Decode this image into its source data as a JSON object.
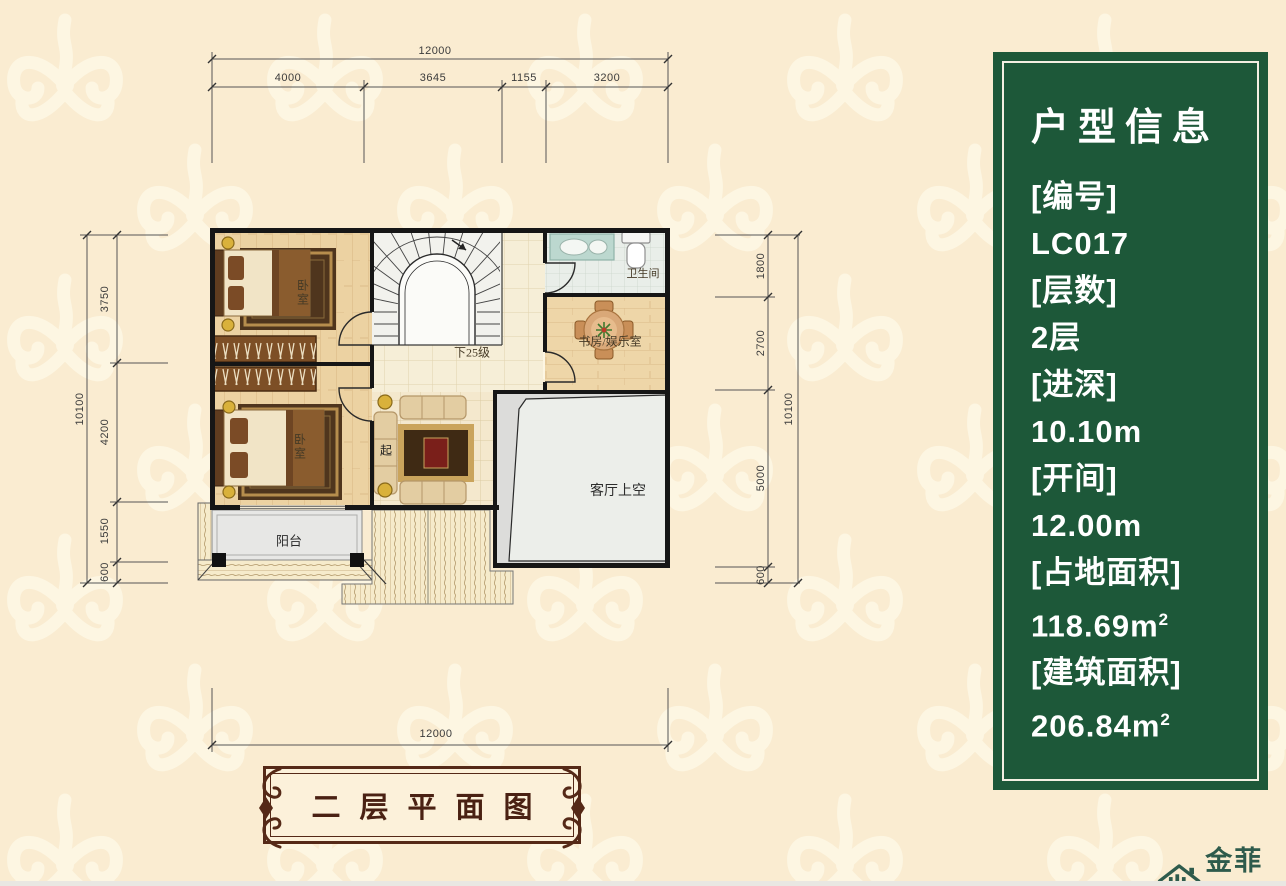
{
  "info_panel": {
    "title": "户型信息",
    "rows": [
      {
        "label": "[编号]",
        "value": "LC017"
      },
      {
        "label": "[层数]",
        "value": "2层"
      },
      {
        "label": "[进深]",
        "value": "10.10m"
      },
      {
        "label": "[开间]",
        "value": "12.00m"
      },
      {
        "label": "[占地面积]",
        "value": "118.69m",
        "sup": "2"
      },
      {
        "label": "[建筑面积]",
        "value": "206.84m",
        "sup": "2"
      }
    ]
  },
  "dimensions": {
    "top": {
      "total": "12000",
      "segments": [
        "4000",
        "3645",
        "1155",
        "3200"
      ]
    },
    "bottom": {
      "total": "12000"
    },
    "left": {
      "total": "10100",
      "segments": [
        "3750",
        "4200",
        "1550",
        "600"
      ]
    },
    "right": {
      "total": "10100",
      "segments": [
        "1800",
        "2700",
        "5000",
        "600"
      ]
    }
  },
  "rooms": {
    "bedroom_top": "卧室",
    "bedroom_bottom": "卧室",
    "bathroom": "卫生间",
    "study": "书房/娱乐室",
    "stairs_note": "下25级",
    "sitting": "起",
    "living_void": "客厅上空",
    "balcony": "阳台"
  },
  "plaque": {
    "title": "二层平面图"
  },
  "logo": {
    "name": "金菲特",
    "latin": "JIN FEI TE"
  },
  "colors": {
    "background": "#faecd1",
    "damask_motif": "#fdf6e2",
    "panel_green": "#1d5839",
    "plaque_brown": "#552917",
    "logo_green": "#2e5b4c",
    "wall_black": "#161616"
  }
}
